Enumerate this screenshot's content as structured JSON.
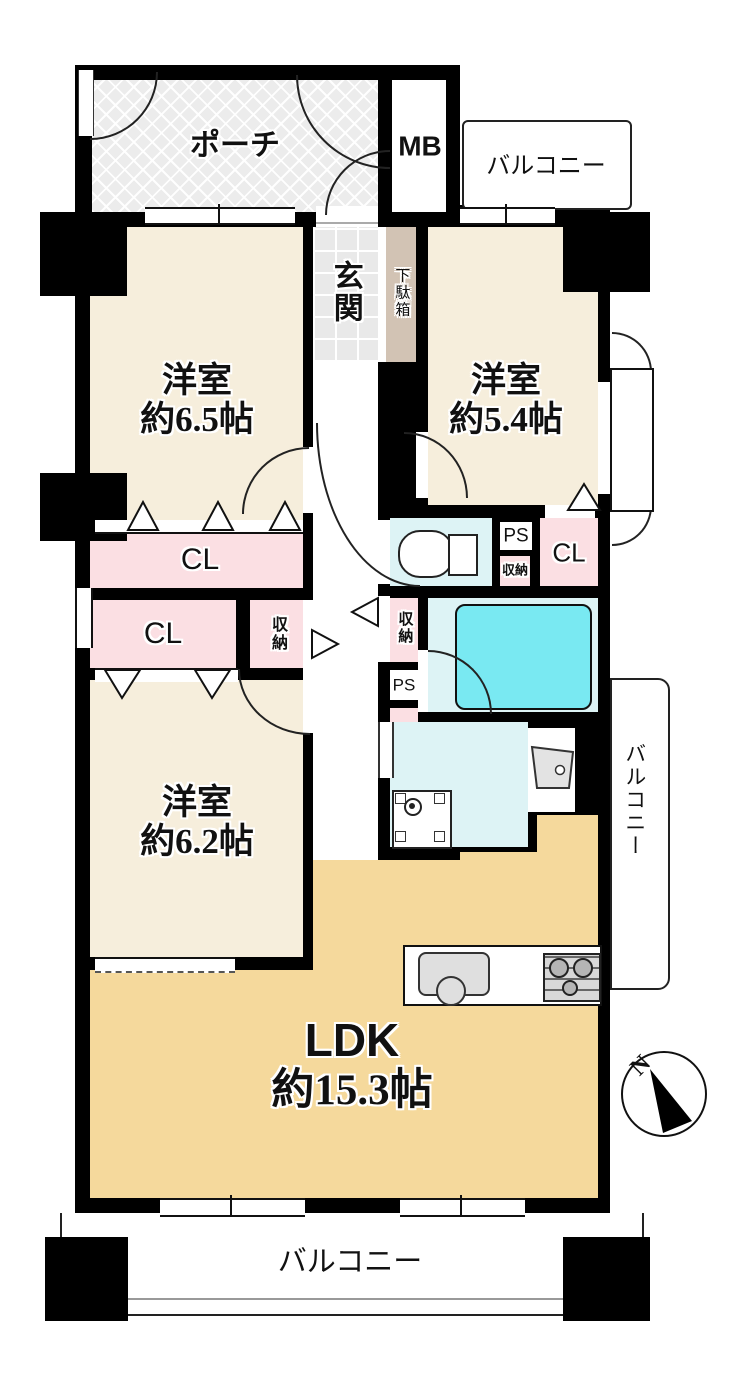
{
  "title": "マンション間取り図 3LDK",
  "colors": {
    "wall": "#000000",
    "cream": "#f6eedc",
    "pink": "#fbdfe3",
    "tan": "#f5d99c",
    "cyan": "#ddf3f5",
    "tub": "#79e9f2",
    "geta": "#d2c3b4"
  },
  "rooms": {
    "r1": {
      "name": "洋室",
      "size": "約6.5帖"
    },
    "r2": {
      "name": "洋室",
      "size": "約5.4帖"
    },
    "r3": {
      "name": "洋室",
      "size": "約6.2帖"
    },
    "ldk": {
      "name": "LDK",
      "size": "約15.3帖"
    }
  },
  "labels": {
    "porch": "ポーチ",
    "mb": "MB",
    "balcony_top": "バルコニー",
    "balcony_right": "バルコニー",
    "balcony_bottom": "バルコニー",
    "genkan": "玄関",
    "getabako": "下駄箱",
    "cl1": "CL",
    "cl2": "CL",
    "cl3": "CL",
    "storage_hall": "収納",
    "storage_bath": "収納",
    "storage_small": "収納",
    "ps1": "PS",
    "ps2": "PS"
  },
  "compass": {
    "north": "N"
  }
}
